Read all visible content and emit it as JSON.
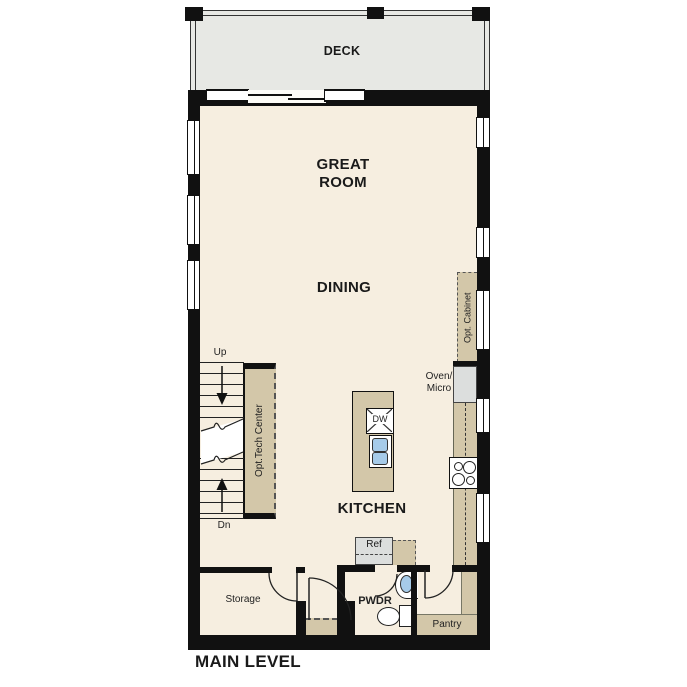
{
  "title": "MAIN LEVEL",
  "colors": {
    "wall": "#111111",
    "floor": "#f6eee0",
    "deck": "#e7e8e4",
    "casework_tan": "#d3c7a9",
    "appliance_gray": "#dcdedd",
    "fixture_blue": "#a6cbe9"
  },
  "deck": {
    "label": "DECK"
  },
  "rooms": {
    "great_room": {
      "line1": "GREAT",
      "line2": "ROOM"
    },
    "dining": {
      "label": "DINING"
    },
    "kitchen": {
      "label": "KITCHEN"
    },
    "powder": {
      "label": "PWDR"
    },
    "storage": {
      "label": "Storage"
    },
    "pantry": {
      "label": "Pantry"
    }
  },
  "stairs": {
    "up_label": "Up",
    "down_label": "Dn"
  },
  "optional_features": {
    "tech_center": "Opt.Tech Center",
    "cabinet": "Opt. Cabinet"
  },
  "appliances": {
    "oven_micro_line1": "Oven/",
    "oven_micro_line2": "Micro",
    "dishwasher": "DW",
    "refrigerator": "Ref"
  }
}
